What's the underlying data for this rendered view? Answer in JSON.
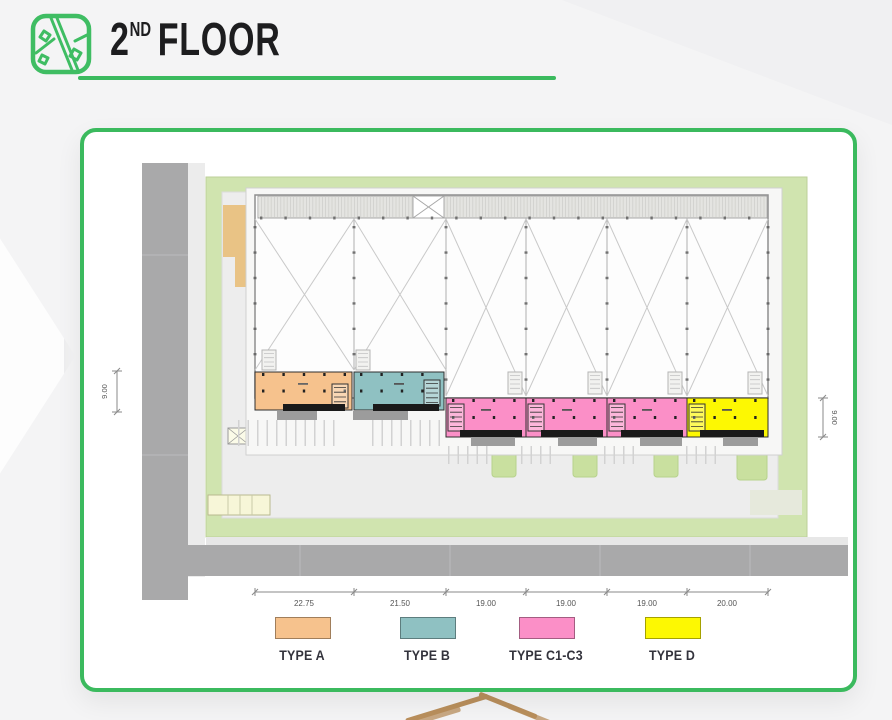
{
  "header": {
    "floor_number": "2",
    "floor_suffix": "ND",
    "floor_word": "FLOOR"
  },
  "dimensions": {
    "bottom": [
      "22.75",
      "21.50",
      "19.00",
      "19.00",
      "19.00",
      "20.00"
    ],
    "left": "9.00",
    "right": "9.00"
  },
  "legend": {
    "items": [
      {
        "label": "TYPE A",
        "color": "#f6c28d"
      },
      {
        "label": "TYPE B",
        "color": "#8fc1c2"
      },
      {
        "label": "TYPE C1-C3",
        "color": "#fb8fc7"
      },
      {
        "label": "TYPE D",
        "color": "#fdf802"
      }
    ]
  },
  "colors": {
    "accent_green": "#3bba5e",
    "site_green": "#d0e4af",
    "planter_green": "#c9e09f",
    "road_gray": "#a9a9aa",
    "pad_gray": "#ededed",
    "tan_strip": "#e9c385",
    "awning_black": "#1a1a1a",
    "gold_line": "#b98f5c"
  }
}
